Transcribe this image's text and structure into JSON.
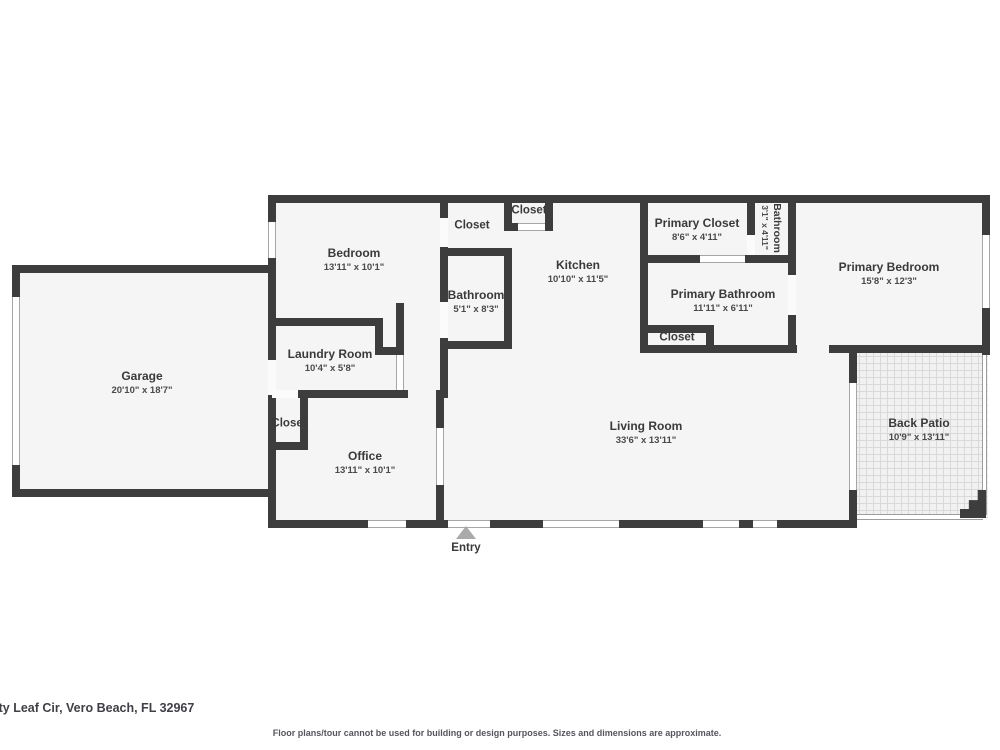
{
  "rooms": {
    "garage": {
      "name": "Garage",
      "dims": "20'10\" x 18'7\""
    },
    "bedroom": {
      "name": "Bedroom",
      "dims": "13'11\" x 10'1\""
    },
    "bedroom_closet": {
      "name": "Closet"
    },
    "top_closet": {
      "name": "Closet"
    },
    "bathroom": {
      "name": "Bathroom",
      "dims": "5'1\" x 8'3\""
    },
    "laundry": {
      "name": "Laundry Room",
      "dims": "10'4\" x 5'8\""
    },
    "kitchen": {
      "name": "Kitchen",
      "dims": "10'10\" x 11'5\""
    },
    "primary_closet": {
      "name": "Primary Closet",
      "dims": "8'6\" x 4'11\""
    },
    "hall_bathroom": {
      "name": "Bathroom",
      "dims": "3'1\" x 4'11\""
    },
    "primary_bathroom": {
      "name": "Primary Bathroom",
      "dims": "11'11\" x 6'11\""
    },
    "pb_closet": {
      "name": "Closet"
    },
    "primary_bedroom": {
      "name": "Primary Bedroom",
      "dims": "15'8\" x 12'3\""
    },
    "office_closet": {
      "name": "Closet"
    },
    "office": {
      "name": "Office",
      "dims": "13'11\" x 10'1\""
    },
    "living_room": {
      "name": "Living Room",
      "dims": "33'6\" x 13'11\""
    },
    "back_patio": {
      "name": "Back Patio",
      "dims": "10'9\" x 13'11\""
    }
  },
  "entry": {
    "label": "Entry"
  },
  "footer": {
    "address": "uty Leaf Cir, Vero Beach, FL 32967",
    "disclaimer": "Floor plans/tour cannot be used for building or design purposes. Sizes and dimensions are approximate."
  },
  "colors": {
    "wall": "#3d3d3d",
    "floor": "#f5f5f5",
    "patio_floor": "#f1f1f1",
    "patio_grid": "#d9d9d9",
    "entry_arrow": "#aaaaaa",
    "label_text": "#3a3a3a",
    "dims_text": "#4a4a4a",
    "footer_text": "#3f3f46"
  }
}
